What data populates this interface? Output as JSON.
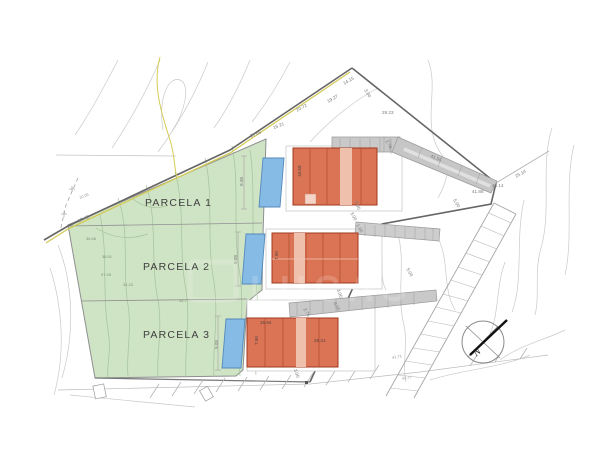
{
  "parcels": {
    "p1": "PARCELA 1",
    "p2": "PARCELA 2",
    "p3": "PARCELA 3"
  },
  "compass": {
    "north": "N"
  },
  "watermark": {
    "text": "LUCAS"
  },
  "dims": {
    "road1": "37.46",
    "road2": "27.65",
    "road3": "16.21",
    "road4": "20.72",
    "road5": "19.27",
    "apex": "14.15",
    "apex_side": "3.00",
    "road6": "29.23",
    "right1": "25.14",
    "corner": "43.14",
    "right2": "41.88",
    "ramp": "41.55",
    "right3": "5.00",
    "road_step": "5.00",
    "b1_h": "18.58",
    "b1_s": "2.76",
    "b1_b": "3.00",
    "b2_h": "7.90",
    "b2_t1": "3.00",
    "b2_t2": "1.90",
    "b2_b": "3.00",
    "b3_w": "15.94",
    "b3_mid": "29.21",
    "b3_h": "7.90",
    "b3_b": "3.00",
    "b3_s": "2.76",
    "b3_s2": "8.00",
    "pool1": "9.08",
    "pool2": "9.08",
    "pool3": "9.08",
    "bot1": "41.71",
    "bot2": "43.77",
    "elev1": "36.46",
    "elev2": "36.51",
    "elev3": "37.45",
    "elev4": "34.23",
    "elev5": "34.7",
    "left1": "10.05"
  },
  "colors": {
    "parcel_green": "#cfe3c5",
    "building_orange": "#db7355",
    "pool_blue": "#85bbe5",
    "ramp_gray": "#c9c9c9",
    "road_yellow": "#d3cb57",
    "boundary_gray": "#666666"
  }
}
